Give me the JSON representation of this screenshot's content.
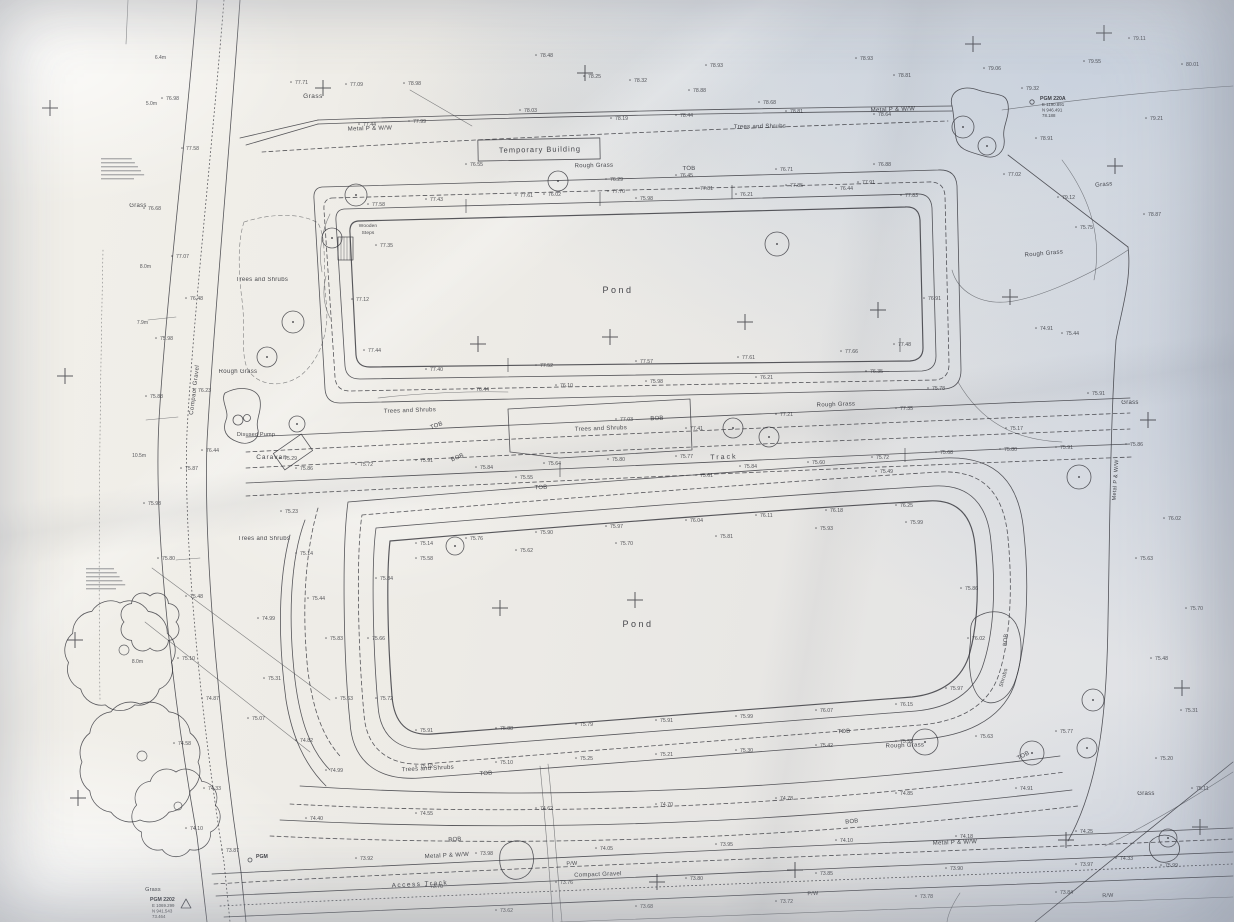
{
  "meta": {
    "description": "Photographed paper topographic site survey plan with two ponds, tracks and tree belts"
  },
  "colors": {
    "ink": "#34353b",
    "paper_warm": "#f2f0ea",
    "paper_cool": "#dfe2e8"
  },
  "labels": [
    [
      "Grass",
      313,
      98,
      6.5,
      0,
      0.5
    ],
    [
      "Metal P & W/W",
      370,
      130,
      6,
      -1.5,
      0.3
    ],
    [
      "Temporary Building",
      540,
      152,
      7.5,
      -1,
      1
    ],
    [
      "Rough Grass",
      594,
      167,
      6,
      -1,
      0.3
    ],
    [
      "TOB",
      689,
      170,
      6,
      -1,
      0.2
    ],
    [
      "Trees and Shrubs",
      760,
      128,
      6,
      -1,
      0.3
    ],
    [
      "Metal P & W/W",
      893,
      111,
      6,
      -2,
      0.3
    ],
    [
      "Grass",
      1104,
      186,
      6,
      -5,
      0.3
    ],
    [
      "Rough Grass",
      1044,
      255,
      6,
      -5,
      0.3
    ],
    [
      "Grass",
      1130,
      404,
      6,
      0,
      0.3
    ],
    [
      "Grass",
      138,
      207,
      6,
      0,
      0.3
    ],
    [
      "Trees and Shrubs",
      262,
      281,
      6,
      0,
      0.3
    ],
    [
      "Rough Grass",
      238,
      373,
      6,
      0,
      0.3
    ],
    [
      "Compact Gravel",
      196,
      390,
      6,
      -83,
      0.5
    ],
    [
      "Disused Pump",
      256,
      436,
      5.5,
      0,
      0.2
    ],
    [
      "Caravan",
      272,
      459,
      6.5,
      0,
      1
    ],
    [
      "Wooden",
      368,
      227,
      4.8,
      0,
      0.1
    ],
    [
      "Steps",
      368,
      234,
      4.8,
      0,
      0.1
    ],
    [
      "Trees and Shrubs",
      410,
      412,
      6,
      -2,
      0.3
    ],
    [
      "TOB",
      437,
      427,
      6,
      -20,
      0.2
    ],
    [
      "BOB",
      458,
      459,
      6,
      -22,
      0.2
    ],
    [
      "Trees and Shrubs",
      601,
      430,
      6,
      -2,
      0.3
    ],
    [
      "BOB",
      657,
      420,
      6,
      -2,
      0.2
    ],
    [
      "TOB",
      541,
      489,
      6,
      -2,
      0.2
    ],
    [
      "Track",
      724,
      459,
      7,
      -2,
      2
    ],
    [
      "Rough Grass",
      836,
      406,
      6,
      -2,
      0.3
    ],
    [
      "Trees and Shrubs",
      264,
      540,
      6,
      0,
      0.3
    ],
    [
      "Pond",
      618,
      293,
      9,
      0,
      2.5
    ],
    [
      "Pond",
      638,
      627,
      9,
      0,
      2.5
    ],
    [
      "Shrubs",
      1005,
      678,
      5.5,
      -75,
      0.3
    ],
    [
      "Metal P & W/W",
      1117,
      480,
      5.5,
      -86,
      0.3
    ],
    [
      "Rough Grass",
      905,
      747,
      6,
      -2,
      0.3
    ],
    [
      "TOB",
      844,
      733,
      6,
      -3,
      0.2
    ],
    [
      "TOB",
      1024,
      757,
      6,
      -28,
      0.2
    ],
    [
      "BOB",
      1007,
      640,
      5.5,
      -85,
      0.2
    ],
    [
      "Trees and Shrubs",
      428,
      770,
      6,
      -3,
      0.3
    ],
    [
      "TOB",
      486,
      775,
      6,
      -3,
      0.2
    ],
    [
      "BOB",
      455,
      841,
      6,
      -3,
      0.2
    ],
    [
      "BOB",
      852,
      823,
      6,
      -5,
      0.2
    ],
    [
      "Metal P & W/W",
      447,
      857,
      6,
      -3,
      0.3
    ],
    [
      "Metal P & W/W",
      955,
      844,
      6,
      -2,
      0.3
    ],
    [
      "Access Track",
      420,
      886,
      6.5,
      -3,
      1.5
    ],
    [
      "Compact Gravel",
      598,
      876,
      6,
      -2,
      0.3
    ],
    [
      "P/W",
      572,
      865,
      5.5,
      -3,
      0.2
    ],
    [
      "P/W",
      813,
      895,
      5.5,
      -3,
      0.2
    ],
    [
      "R/W",
      1108,
      897,
      5.5,
      -3,
      0.2
    ],
    [
      "Grass",
      1146,
      795,
      6,
      0,
      0.3
    ],
    [
      "Grass",
      153,
      891,
      5.5,
      0,
      0.2
    ]
  ],
  "stations": [
    {
      "name": "PGM 220A",
      "lines": [
        "E 1190.891",
        "N 946.491",
        "78.188"
      ],
      "x": 1040,
      "y": 100
    },
    {
      "name": "PGM 2202",
      "lines": [
        "E 1069.299",
        "N 941.543",
        "73.464"
      ],
      "x": 150,
      "y": 901
    },
    {
      "name": "PGM",
      "lines": [],
      "x": 256,
      "y": 858
    }
  ],
  "notes": [
    {
      "x": 101,
      "y": 158,
      "w": 44,
      "lines": 6,
      "desc": "small survey annotation (illegible)"
    },
    {
      "x": 86,
      "y": 568,
      "w": 40,
      "lines": 6,
      "desc": "small survey annotation (illegible)"
    }
  ],
  "tree_heights": [
    [
      "6.4m",
      166,
      59
    ],
    [
      "5.0m",
      157,
      105
    ],
    [
      "8.0m",
      151,
      268
    ],
    [
      "7.9m",
      148,
      324
    ],
    [
      "10.5m",
      146,
      457
    ],
    [
      "8.0m",
      143,
      663
    ]
  ],
  "crosses": [
    [
      50,
      108
    ],
    [
      323,
      88
    ],
    [
      585,
      73
    ],
    [
      973,
      44
    ],
    [
      1104,
      33
    ],
    [
      1115,
      166
    ],
    [
      65,
      376
    ],
    [
      478,
      344
    ],
    [
      610,
      337
    ],
    [
      745,
      322
    ],
    [
      878,
      310
    ],
    [
      1010,
      297
    ],
    [
      1148,
      420
    ],
    [
      75,
      640
    ],
    [
      500,
      608
    ],
    [
      635,
      600
    ],
    [
      1182,
      688
    ],
    [
      78,
      798
    ],
    [
      657,
      882
    ],
    [
      795,
      870
    ],
    [
      1066,
      840
    ],
    [
      1200,
      827
    ]
  ],
  "ticks": [
    [
      466,
      206
    ],
    [
      600,
      199
    ],
    [
      732,
      192
    ],
    [
      508,
      365
    ],
    [
      900,
      345
    ],
    [
      560,
      470
    ],
    [
      905,
      455
    ]
  ],
  "trees": [
    [
      356,
      195,
      11
    ],
    [
      332,
      238,
      10
    ],
    [
      293,
      322,
      11
    ],
    [
      267,
      357,
      10
    ],
    [
      558,
      181,
      10
    ],
    [
      777,
      244,
      12
    ],
    [
      733,
      428,
      10
    ],
    [
      769,
      437,
      10
    ],
    [
      297,
      424,
      8
    ],
    [
      455,
      546,
      9
    ],
    [
      1079,
      477,
      12
    ],
    [
      925,
      742,
      13
    ],
    [
      1032,
      753,
      12
    ],
    [
      1093,
      700,
      11
    ],
    [
      1087,
      748,
      10
    ],
    [
      1168,
      838,
      9
    ],
    [
      963,
      127,
      11
    ],
    [
      987,
      146,
      9
    ]
  ],
  "clouds": [
    [
      120,
      655,
      52,
      11
    ],
    [
      140,
      762,
      58,
      12
    ],
    [
      176,
      812,
      40,
      9
    ],
    [
      150,
      622,
      26,
      8
    ]
  ],
  "trunks": [
    [
      124,
      650,
      5
    ],
    [
      142,
      756,
      5
    ],
    [
      178,
      806,
      4
    ]
  ],
  "spots": [
    [
      "77.71",
      295,
      84
    ],
    [
      "77.09",
      350,
      86
    ],
    [
      "78.98",
      408,
      85
    ],
    [
      "78.48",
      540,
      57
    ],
    [
      "78.25",
      588,
      78
    ],
    [
      "78.32",
      634,
      82
    ],
    [
      "78.93",
      710,
      67
    ],
    [
      "78.88",
      693,
      92
    ],
    [
      "78.68",
      763,
      104
    ],
    [
      "78.81",
      898,
      77
    ],
    [
      "78.93",
      860,
      60
    ],
    [
      "79.06",
      988,
      70
    ],
    [
      "79.55",
      1088,
      63
    ],
    [
      "80.01",
      1186,
      66
    ],
    [
      "78.64",
      878,
      116
    ],
    [
      "79.32",
      1026,
      90
    ],
    [
      "77.44",
      363,
      126
    ],
    [
      "77.99",
      413,
      123
    ],
    [
      "78.03",
      524,
      112
    ],
    [
      "78.19",
      615,
      120
    ],
    [
      "78.44",
      680,
      117
    ],
    [
      "78.81",
      790,
      113
    ],
    [
      "79.11",
      1133,
      40
    ],
    [
      "78.91",
      1040,
      140
    ],
    [
      "79.21",
      1150,
      120
    ],
    [
      "76.29",
      610,
      181
    ],
    [
      "76.45",
      680,
      177
    ],
    [
      "76.71",
      780,
      171
    ],
    [
      "76.88",
      878,
      166
    ],
    [
      "77.02",
      1008,
      176
    ],
    [
      "76.55",
      470,
      166
    ],
    [
      "76.02",
      548,
      196
    ],
    [
      "75.98",
      640,
      200
    ],
    [
      "76.21",
      740,
      196
    ],
    [
      "76.44",
      840,
      190
    ],
    [
      "77.58",
      372,
      206
    ],
    [
      "77.43",
      430,
      201
    ],
    [
      "77.61",
      520,
      197
    ],
    [
      "77.70",
      612,
      193
    ],
    [
      "77.81",
      700,
      190
    ],
    [
      "77.85",
      790,
      187
    ],
    [
      "77.91",
      862,
      184
    ],
    [
      "77.83",
      905,
      197
    ],
    [
      "77.35",
      380,
      247
    ],
    [
      "77.12",
      356,
      301
    ],
    [
      "77.44",
      368,
      352
    ],
    [
      "77.40",
      430,
      371
    ],
    [
      "77.52",
      540,
      367
    ],
    [
      "77.57",
      640,
      363
    ],
    [
      "77.61",
      742,
      359
    ],
    [
      "77.66",
      845,
      353
    ],
    [
      "77.48",
      898,
      346
    ],
    [
      "76.91",
      928,
      300
    ],
    [
      "76.44",
      476,
      391
    ],
    [
      "76.10",
      560,
      387
    ],
    [
      "75.98",
      650,
      383
    ],
    [
      "76.21",
      760,
      379
    ],
    [
      "76.35",
      870,
      373
    ],
    [
      "75.78",
      932,
      390
    ],
    [
      "76.98",
      166,
      100
    ],
    [
      "77.58",
      186,
      150
    ],
    [
      "76.68",
      148,
      210
    ],
    [
      "77.07",
      176,
      258
    ],
    [
      "76.48",
      190,
      300
    ],
    [
      "75.98",
      160,
      340
    ],
    [
      "76.23",
      198,
      392
    ],
    [
      "75.88",
      150,
      398
    ],
    [
      "76.44",
      206,
      452
    ],
    [
      "75.87",
      185,
      470
    ],
    [
      "75.98",
      148,
      505
    ],
    [
      "75.80",
      162,
      560
    ],
    [
      "75.48",
      190,
      598
    ],
    [
      "75.10",
      182,
      660
    ],
    [
      "74.87",
      206,
      700
    ],
    [
      "74.58",
      178,
      745
    ],
    [
      "74.33",
      208,
      790
    ],
    [
      "74.10",
      190,
      830
    ],
    [
      "73.87",
      226,
      852
    ],
    [
      "75.29",
      284,
      460
    ],
    [
      "75.23",
      285,
      513
    ],
    [
      "75.14",
      300,
      555
    ],
    [
      "75.44",
      312,
      600
    ],
    [
      "74.99",
      262,
      620
    ],
    [
      "75.83",
      330,
      640
    ],
    [
      "75.31",
      268,
      680
    ],
    [
      "75.07",
      252,
      720
    ],
    [
      "74.82",
      300,
      742
    ],
    [
      "75.63",
      340,
      700
    ],
    [
      "75.86",
      300,
      470
    ],
    [
      "75.72",
      360,
      466
    ],
    [
      "75.91",
      420,
      462
    ],
    [
      "75.84",
      480,
      469
    ],
    [
      "75.64",
      548,
      465
    ],
    [
      "75.80",
      612,
      461
    ],
    [
      "75.77",
      680,
      458
    ],
    [
      "75.84",
      744,
      468
    ],
    [
      "75.60",
      812,
      464
    ],
    [
      "75.72",
      876,
      459
    ],
    [
      "75.68",
      940,
      454
    ],
    [
      "75.80",
      1004,
      451
    ],
    [
      "75.91",
      1060,
      449
    ],
    [
      "75.55",
      520,
      479
    ],
    [
      "75.61",
      700,
      477
    ],
    [
      "75.49",
      880,
      473
    ],
    [
      "77.41",
      690,
      430
    ],
    [
      "77.03",
      620,
      421
    ],
    [
      "77.21",
      780,
      416
    ],
    [
      "77.35",
      900,
      410
    ],
    [
      "79.12",
      1062,
      199
    ],
    [
      "78.87",
      1148,
      216
    ],
    [
      "75.75",
      1080,
      229
    ],
    [
      "75.44",
      1066,
      335
    ],
    [
      "75.91",
      1092,
      395
    ],
    [
      "75.86",
      1130,
      446
    ],
    [
      "76.02",
      1168,
      520
    ],
    [
      "75.63",
      1140,
      560
    ],
    [
      "75.70",
      1190,
      610
    ],
    [
      "75.48",
      1155,
      660
    ],
    [
      "75.31",
      1185,
      712
    ],
    [
      "75.20",
      1160,
      760
    ],
    [
      "75.11",
      1196,
      790
    ],
    [
      "74.91",
      1040,
      330
    ],
    [
      "75.17",
      1010,
      430
    ],
    [
      "75.14",
      420,
      545
    ],
    [
      "75.76",
      470,
      540
    ],
    [
      "75.90",
      540,
      534
    ],
    [
      "75.97",
      610,
      528
    ],
    [
      "76.04",
      690,
      522
    ],
    [
      "76.11",
      760,
      517
    ],
    [
      "76.18",
      830,
      512
    ],
    [
      "76.25",
      900,
      507
    ],
    [
      "75.84",
      380,
      580
    ],
    [
      "75.66",
      372,
      640
    ],
    [
      "75.72",
      380,
      700
    ],
    [
      "75.91",
      420,
      732
    ],
    [
      "75.88",
      500,
      730
    ],
    [
      "75.79",
      580,
      726
    ],
    [
      "75.91",
      660,
      722
    ],
    [
      "75.99",
      740,
      718
    ],
    [
      "76.07",
      820,
      712
    ],
    [
      "76.15",
      900,
      706
    ],
    [
      "75.97",
      950,
      690
    ],
    [
      "76.02",
      972,
      640
    ],
    [
      "75.86",
      965,
      590
    ],
    [
      "75.58",
      420,
      560
    ],
    [
      "75.62",
      520,
      552
    ],
    [
      "75.70",
      620,
      545
    ],
    [
      "75.81",
      720,
      538
    ],
    [
      "75.93",
      820,
      530
    ],
    [
      "75.99",
      910,
      524
    ],
    [
      "74.99",
      330,
      772
    ],
    [
      "75.12",
      420,
      768
    ],
    [
      "75.10",
      500,
      764
    ],
    [
      "75.25",
      580,
      760
    ],
    [
      "75.21",
      660,
      756
    ],
    [
      "75.30",
      740,
      752
    ],
    [
      "75.42",
      820,
      747
    ],
    [
      "75.55",
      900,
      743
    ],
    [
      "75.63",
      980,
      738
    ],
    [
      "75.77",
      1060,
      733
    ],
    [
      "74.40",
      310,
      820
    ],
    [
      "74.55",
      420,
      815
    ],
    [
      "74.62",
      540,
      810
    ],
    [
      "74.70",
      660,
      806
    ],
    [
      "74.78",
      780,
      800
    ],
    [
      "74.85",
      900,
      795
    ],
    [
      "74.91",
      1020,
      790
    ],
    [
      "73.92",
      360,
      860
    ],
    [
      "73.98",
      480,
      855
    ],
    [
      "74.05",
      600,
      850
    ],
    [
      "73.95",
      720,
      846
    ],
    [
      "74.10",
      840,
      842
    ],
    [
      "74.18",
      960,
      838
    ],
    [
      "74.25",
      1080,
      833
    ],
    [
      "73.70",
      430,
      888
    ],
    [
      "73.76",
      560,
      884
    ],
    [
      "73.80",
      690,
      880
    ],
    [
      "73.85",
      820,
      875
    ],
    [
      "73.90",
      950,
      870
    ],
    [
      "73.97",
      1080,
      866
    ],
    [
      "73.62",
      500,
      912
    ],
    [
      "73.68",
      640,
      908
    ],
    [
      "73.72",
      780,
      903
    ],
    [
      "73.78",
      920,
      898
    ],
    [
      "73.84",
      1060,
      894
    ],
    [
      "75.99",
      1165,
      867
    ],
    [
      "74.33",
      1120,
      860
    ]
  ]
}
